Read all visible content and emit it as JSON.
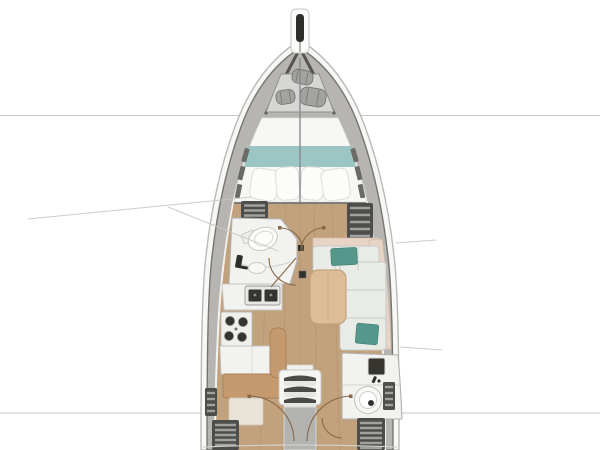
{
  "image": {
    "kind": "sailboat-yacht-interior-floor-plan",
    "view": "top-down",
    "width_px": 600,
    "height_px": 450,
    "background": "#ffffff",
    "visible_text": []
  },
  "palette": {
    "hull-outline": "#b9b9b7",
    "hull-fill": "#f7f7f5",
    "deck": "#b7b5b2",
    "deck-edge": "#77756f",
    "bow-rail": "#55544f",
    "locker-dark": "#4d4d4b",
    "locker-slat": "#a3a19d",
    "interior": "#f3f3f1",
    "bed-linen": "#f7f7f5",
    "pillow-stroke": "#dddddb",
    "blanket-teal": "#9cc6c3",
    "floor-wood": "#c2a27c",
    "floor-grain": "#a98a64",
    "counter-white": "#f2f2f0",
    "fixture-stroke": "#c2c2c0",
    "sink-dark": "#35342f",
    "bench-wood": "#c59a6e",
    "bench-stroke": "#a87f55",
    "cushion": "#e9ebe7",
    "cushion-seam": "#c9cbc7",
    "backrest-beige": "#e7d4c5",
    "pillow-teal": "#55988b",
    "table-wood": "#dcbe96",
    "table-stroke": "#bb9b72",
    "stairs-panel": "#b3b3b1",
    "door-arc": "#8a6848",
    "section-line": "#c6c6c4",
    "anchor-slot": "#2e2e2c",
    "fender": "#a2a29f",
    "fender-stroke": "#6f6f6d",
    "wall-dark": "#6b6b69",
    "post-dark": "#2f2f2d"
  },
  "sections": {
    "bow": {
      "fixtures": [
        "bowsprit-anchor-roller",
        "anchor-locker",
        "fender-1",
        "fender-2",
        "fender-3"
      ]
    },
    "forward_cabin": {
      "fixtures": [
        "v-berth-double-bed",
        "teal-blanket",
        "pillows-x4",
        "centerline-split",
        "side-deck-vents",
        "double-entry-doors"
      ]
    },
    "forward_head": {
      "fixtures": [
        "toilet",
        "vanity-sink",
        "faucet",
        "entry-door"
      ]
    },
    "galley": {
      "fixtures": [
        "double-sink",
        "two-burner-stove",
        "counter-block",
        "wood-bench-seat",
        "lower-step-cabinet"
      ]
    },
    "salon": {
      "fixtures": [
        "l-shaped-settee",
        "beige-backrest",
        "teal-accent-pillow-fwd",
        "teal-accent-pillow-aft",
        "dining-table",
        "nav-seat",
        "mast-post"
      ]
    },
    "aft_head": {
      "fixtures": [
        "dark-sink",
        "round-washbasin",
        "entry-door"
      ]
    },
    "companionway": {
      "fixtures": [
        "three-step-ladder",
        "engine-compartment-panel",
        "port-aft-cabin-door",
        "starboard-aft-cabin-door"
      ]
    },
    "side_storage": {
      "fixtures": [
        "port-fwd-slat-locker",
        "stbd-fwd-slat-locker",
        "port-aft-slat-locker",
        "stbd-aft-slat-locker",
        "port-side-vent-strip",
        "stbd-side-vent-strip"
      ]
    },
    "drawing_marks": {
      "fixtures": [
        "bow-section-line",
        "stern-section-line",
        "port-callout-line-upper",
        "port-callout-line-lower",
        "stbd-tick-fwd",
        "stbd-tick-aft"
      ]
    }
  }
}
